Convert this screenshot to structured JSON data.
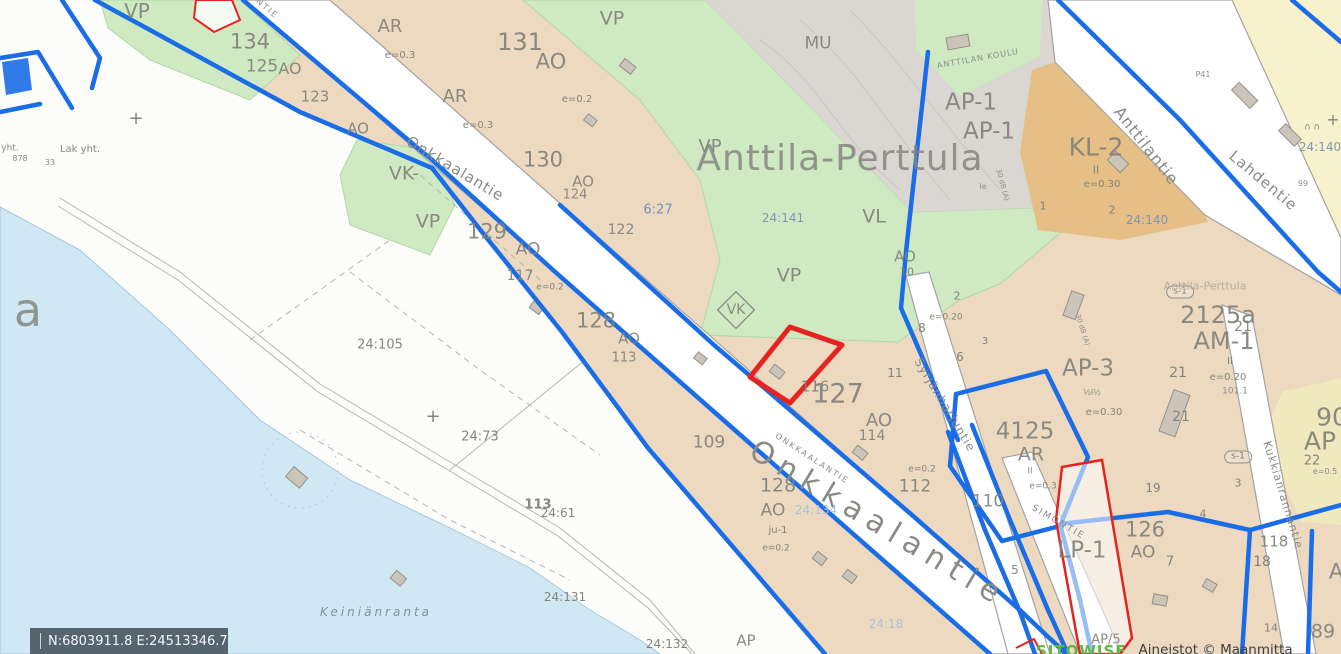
{
  "map": {
    "place_name": "Anttila-Perttula",
    "statusbar": {
      "coordinates": "N:6803911.8 E:24513346.7"
    },
    "attribution": {
      "logo_text": "SITOWISE",
      "credit_text": "Aineistot © Maanmitta"
    },
    "colors": {
      "plan_boundary_blue": "#1a6de6",
      "selected_parcel_red": "#e62320",
      "residential_tan": "#ecd9c0",
      "park_green": "#cfe9c2",
      "forest_gray": "#dad6d1",
      "commercial_orange": "#e5bf85",
      "reserve_yellow": "#f7f2cc",
      "water_blue": "#cfe8f3",
      "statusbar_bg": "#566470"
    },
    "labels": [
      {
        "t": "VP",
        "x": 137,
        "y": 11,
        "s": 20,
        "c": "zone"
      },
      {
        "t": "134",
        "x": 250,
        "y": 42,
        "s": 21,
        "c": "zone"
      },
      {
        "t": "125",
        "x": 262,
        "y": 67,
        "s": 17,
        "c": "zone"
      },
      {
        "t": "AO",
        "x": 290,
        "y": 69,
        "s": 16,
        "c": "zone"
      },
      {
        "t": "123",
        "x": 315,
        "y": 97,
        "s": 15,
        "c": "zone"
      },
      {
        "t": "AO",
        "x": 358,
        "y": 129,
        "s": 15,
        "c": "zone"
      },
      {
        "t": "AR",
        "x": 390,
        "y": 27,
        "s": 18,
        "c": "zone"
      },
      {
        "t": "e=0.3",
        "x": 400,
        "y": 56,
        "s": 10,
        "c": "num"
      },
      {
        "t": "AR",
        "x": 455,
        "y": 97,
        "s": 18,
        "c": "zone"
      },
      {
        "t": "e=0.3",
        "x": 478,
        "y": 126,
        "s": 10,
        "c": "num"
      },
      {
        "t": "131",
        "x": 520,
        "y": 42,
        "s": 24,
        "c": "zone"
      },
      {
        "t": "AO",
        "x": 551,
        "y": 62,
        "s": 21,
        "c": "zone"
      },
      {
        "t": "e=0.2",
        "x": 577,
        "y": 100,
        "s": 10,
        "c": "num"
      },
      {
        "t": "VP",
        "x": 612,
        "y": 19,
        "s": 19,
        "c": "zone"
      },
      {
        "t": "MU",
        "x": 818,
        "y": 44,
        "s": 17,
        "c": "zone"
      },
      {
        "t": "VP",
        "x": 710,
        "y": 147,
        "s": 18,
        "c": "zone"
      },
      {
        "t": "Anttila-Perttula",
        "x": 840,
        "y": 159,
        "s": 36,
        "c": "title",
        "ls": 1
      },
      {
        "t": "VK-",
        "x": 404,
        "y": 174,
        "s": 19,
        "c": "zone"
      },
      {
        "t": "VP",
        "x": 428,
        "y": 222,
        "s": 19,
        "c": "zone"
      },
      {
        "t": "129",
        "x": 487,
        "y": 232,
        "s": 21,
        "c": "zone"
      },
      {
        "t": "AO",
        "x": 528,
        "y": 250,
        "s": 17,
        "c": "zone"
      },
      {
        "t": "117",
        "x": 520,
        "y": 276,
        "s": 14,
        "c": "zone"
      },
      {
        "t": "e=0.2",
        "x": 550,
        "y": 288,
        "s": 9,
        "c": "num"
      },
      {
        "t": "130",
        "x": 543,
        "y": 160,
        "s": 21,
        "c": "zone"
      },
      {
        "t": "AO",
        "x": 583,
        "y": 182,
        "s": 15,
        "c": "zone"
      },
      {
        "t": "124",
        "x": 575,
        "y": 195,
        "s": 13,
        "c": "zone"
      },
      {
        "t": "122",
        "x": 621,
        "y": 230,
        "s": 14,
        "c": "zone"
      },
      {
        "t": "128",
        "x": 596,
        "y": 321,
        "s": 21,
        "c": "zone"
      },
      {
        "t": "AO",
        "x": 629,
        "y": 339,
        "s": 15,
        "c": "zone"
      },
      {
        "t": "113",
        "x": 624,
        "y": 358,
        "s": 13,
        "c": "zone"
      },
      {
        "t": "24:141",
        "x": 783,
        "y": 218,
        "s": 12,
        "c": "steel"
      },
      {
        "t": "VL",
        "x": 874,
        "y": 217,
        "s": 19,
        "c": "zone"
      },
      {
        "t": "VP",
        "x": 789,
        "y": 276,
        "s": 19,
        "c": "zone"
      },
      {
        "t": "VK",
        "x": 736,
        "y": 310,
        "s": 14,
        "c": "zone"
      },
      {
        "t": "AO",
        "x": 905,
        "y": 257,
        "s": 15,
        "c": "zone"
      },
      {
        "t": "10",
        "x": 907,
        "y": 272,
        "s": 11,
        "c": "num"
      },
      {
        "t": "e=0.20",
        "x": 946,
        "y": 318,
        "s": 9,
        "c": "num"
      },
      {
        "t": "2",
        "x": 957,
        "y": 296,
        "s": 11,
        "c": "num"
      },
      {
        "t": "8",
        "x": 922,
        "y": 328,
        "s": 12,
        "c": "num"
      },
      {
        "t": "3",
        "x": 985,
        "y": 342,
        "s": 10,
        "c": "num"
      },
      {
        "t": "6",
        "x": 960,
        "y": 357,
        "s": 12,
        "c": "num"
      },
      {
        "t": "11",
        "x": 895,
        "y": 373,
        "s": 12,
        "c": "num"
      },
      {
        "t": "116",
        "x": 815,
        "y": 387,
        "s": 15,
        "c": "zone"
      },
      {
        "t": "127",
        "x": 838,
        "y": 394,
        "s": 27,
        "c": "zone"
      },
      {
        "t": "AO",
        "x": 879,
        "y": 421,
        "s": 18,
        "c": "zone"
      },
      {
        "t": "114",
        "x": 872,
        "y": 436,
        "s": 14,
        "c": "zone"
      },
      {
        "t": "109",
        "x": 709,
        "y": 443,
        "s": 17,
        "c": "zone"
      },
      {
        "t": "128",
        "x": 778,
        "y": 486,
        "s": 19,
        "c": "zone"
      },
      {
        "t": "AO",
        "x": 773,
        "y": 511,
        "s": 17,
        "c": "zone"
      },
      {
        "t": "ju-1",
        "x": 778,
        "y": 531,
        "s": 10,
        "c": "num"
      },
      {
        "t": "e=0.2",
        "x": 776,
        "y": 549,
        "s": 9,
        "c": "num"
      },
      {
        "t": "112",
        "x": 915,
        "y": 487,
        "s": 17,
        "c": "zone"
      },
      {
        "t": "e=0.2",
        "x": 922,
        "y": 470,
        "s": 9,
        "c": "num"
      },
      {
        "t": "110",
        "x": 988,
        "y": 502,
        "s": 17,
        "c": "zone"
      },
      {
        "t": "24:134",
        "x": 816,
        "y": 510,
        "s": 12,
        "c": "pale"
      },
      {
        "t": "24:18",
        "x": 886,
        "y": 624,
        "s": 12,
        "c": "pale"
      },
      {
        "t": "24:132",
        "x": 667,
        "y": 644,
        "s": 12,
        "c": "num"
      },
      {
        "t": "24:131",
        "x": 565,
        "y": 597,
        "s": 12,
        "c": "num"
      },
      {
        "t": "Keiniänranta",
        "x": 376,
        "y": 612,
        "s": 12,
        "c": "water",
        "ls": 3,
        "st": "italic"
      },
      {
        "t": "24:105",
        "x": 380,
        "y": 345,
        "s": 13,
        "c": "num"
      },
      {
        "t": "24:73",
        "x": 480,
        "y": 437,
        "s": 13,
        "c": "num"
      },
      {
        "t": "113",
        "x": 538,
        "y": 505,
        "s": 13,
        "c": "num",
        "w": 600
      },
      {
        "t": "24:61",
        "x": 558,
        "y": 513,
        "s": 12,
        "c": "num"
      },
      {
        "t": "6:27",
        "x": 658,
        "y": 210,
        "s": 13,
        "c": "blue"
      },
      {
        "t": "a",
        "x": 28,
        "y": 310,
        "s": 46,
        "c": "title"
      },
      {
        "t": "Lak yht.",
        "x": 80,
        "y": 150,
        "s": 10,
        "c": "num"
      },
      {
        "t": "yht.",
        "x": 10,
        "y": 149,
        "s": 9,
        "c": "num"
      },
      {
        "t": "878",
        "x": 20,
        "y": 159,
        "s": 8,
        "c": "num"
      },
      {
        "t": "33",
        "x": 50,
        "y": 163,
        "s": 8,
        "c": "num"
      },
      {
        "t": "+",
        "x": 136,
        "y": 119,
        "s": 18,
        "c": "num"
      },
      {
        "t": "+",
        "x": 433,
        "y": 417,
        "s": 18,
        "c": "num"
      },
      {
        "t": "+",
        "x": 1333,
        "y": 120,
        "s": 16,
        "c": "num"
      },
      {
        "t": "∩ ∩",
        "x": 1312,
        "y": 128,
        "s": 9,
        "c": "num"
      },
      {
        "t": "AP-1",
        "x": 971,
        "y": 103,
        "s": 23,
        "c": "zone"
      },
      {
        "t": "AP-1",
        "x": 989,
        "y": 132,
        "s": 23,
        "c": "zone"
      },
      {
        "t": "KL-2",
        "x": 1096,
        "y": 147,
        "s": 25,
        "c": "zone"
      },
      {
        "t": "II",
        "x": 1096,
        "y": 170,
        "s": 11,
        "c": "num"
      },
      {
        "t": "e=0.30",
        "x": 1102,
        "y": 185,
        "s": 10,
        "c": "num"
      },
      {
        "t": "1",
        "x": 1043,
        "y": 206,
        "s": 11,
        "c": "num"
      },
      {
        "t": "2",
        "x": 1112,
        "y": 210,
        "s": 11,
        "c": "num"
      },
      {
        "t": "ANTTILAN KOULU",
        "x": 978,
        "y": 59,
        "s": 8,
        "c": "tiny",
        "ls": 1,
        "r": -10
      },
      {
        "t": "P41",
        "x": 1203,
        "y": 75,
        "s": 8,
        "c": "tiny"
      },
      {
        "t": "24:140",
        "x": 1147,
        "y": 220,
        "s": 12,
        "c": "steel"
      },
      {
        "t": "24:140",
        "x": 1320,
        "y": 147,
        "s": 12,
        "c": "steel"
      },
      {
        "t": "99",
        "x": 1303,
        "y": 184,
        "s": 8,
        "c": "tiny"
      },
      {
        "t": "Anttilantie",
        "x": 1146,
        "y": 146,
        "s": 16,
        "c": "street",
        "r": 52,
        "ls": 1
      },
      {
        "t": "Lahdentie",
        "x": 1263,
        "y": 181,
        "s": 15,
        "c": "street",
        "r": 40,
        "ls": 1
      },
      {
        "t": "30 dB (A)",
        "x": 1002,
        "y": 185,
        "s": 7,
        "c": "tiny",
        "r": 75
      },
      {
        "t": "le",
        "x": 983,
        "y": 187,
        "s": 8,
        "c": "tiny"
      },
      {
        "t": "30 dB (A)",
        "x": 1082,
        "y": 330,
        "s": 7,
        "c": "tiny",
        "r": 72
      },
      {
        "t": "2125a",
        "x": 1218,
        "y": 315,
        "s": 24,
        "c": "zone"
      },
      {
        "t": "21",
        "x": 1243,
        "y": 327,
        "s": 14,
        "c": "zone"
      },
      {
        "t": "AM-1",
        "x": 1224,
        "y": 341,
        "s": 24,
        "c": "zone"
      },
      {
        "t": "s-1",
        "x": 1180,
        "y": 292,
        "s": 9,
        "c": "oval"
      },
      {
        "t": "s-1",
        "x": 1238,
        "y": 457,
        "s": 9,
        "c": "oval"
      },
      {
        "t": "Anttila-Perttula",
        "x": 1205,
        "y": 286,
        "s": 11,
        "c": "faint"
      },
      {
        "t": "AP-3",
        "x": 1088,
        "y": 369,
        "s": 23,
        "c": "zone"
      },
      {
        "t": "½I½",
        "x": 1092,
        "y": 393,
        "s": 8,
        "c": "tiny"
      },
      {
        "t": "e=0.30",
        "x": 1104,
        "y": 413,
        "s": 10,
        "c": "num"
      },
      {
        "t": "21",
        "x": 1178,
        "y": 373,
        "s": 14,
        "c": "num"
      },
      {
        "t": "II",
        "x": 1230,
        "y": 362,
        "s": 10,
        "c": "num"
      },
      {
        "t": "e=0.20",
        "x": 1228,
        "y": 378,
        "s": 10,
        "c": "num"
      },
      {
        "t": "101.1",
        "x": 1235,
        "y": 392,
        "s": 9,
        "c": "tiny"
      },
      {
        "t": "21",
        "x": 1181,
        "y": 417,
        "s": 14,
        "c": "num"
      },
      {
        "t": "4125",
        "x": 1025,
        "y": 432,
        "s": 23,
        "c": "zone"
      },
      {
        "t": "AR",
        "x": 1031,
        "y": 455,
        "s": 19,
        "c": "zone"
      },
      {
        "t": "II",
        "x": 1030,
        "y": 472,
        "s": 9,
        "c": "tiny"
      },
      {
        "t": "e=0.3",
        "x": 1043,
        "y": 487,
        "s": 9,
        "c": "num"
      },
      {
        "t": "Syrjänharjuntie",
        "x": 945,
        "y": 405,
        "s": 12,
        "c": "street",
        "r": 59,
        "ls": 1
      },
      {
        "t": "SIMONTIE",
        "x": 1058,
        "y": 523,
        "s": 9,
        "c": "street",
        "r": 30,
        "ls": 2
      },
      {
        "t": "LP-1",
        "x": 1082,
        "y": 551,
        "s": 23,
        "c": "zone"
      },
      {
        "t": "126",
        "x": 1145,
        "y": 530,
        "s": 21,
        "c": "zone"
      },
      {
        "t": "AO",
        "x": 1143,
        "y": 553,
        "s": 17,
        "c": "zone"
      },
      {
        "t": "7",
        "x": 1170,
        "y": 562,
        "s": 13,
        "c": "num"
      },
      {
        "t": "19",
        "x": 1153,
        "y": 488,
        "s": 12,
        "c": "num"
      },
      {
        "t": "4",
        "x": 1203,
        "y": 514,
        "s": 11,
        "c": "num"
      },
      {
        "t": "3",
        "x": 1238,
        "y": 483,
        "s": 11,
        "c": "num"
      },
      {
        "t": "5",
        "x": 1015,
        "y": 570,
        "s": 12,
        "c": "num"
      },
      {
        "t": "118",
        "x": 1274,
        "y": 542,
        "s": 15,
        "c": "zone"
      },
      {
        "t": "18",
        "x": 1262,
        "y": 562,
        "s": 14,
        "c": "num"
      },
      {
        "t": "90",
        "x": 1332,
        "y": 417,
        "s": 25,
        "c": "zone"
      },
      {
        "t": "AP",
        "x": 1320,
        "y": 441,
        "s": 25,
        "c": "zone"
      },
      {
        "t": "22",
        "x": 1312,
        "y": 461,
        "s": 13,
        "c": "num"
      },
      {
        "t": "e=0.5",
        "x": 1325,
        "y": 472,
        "s": 8,
        "c": "tiny"
      },
      {
        "t": "Kukkianrannantie",
        "x": 1283,
        "y": 495,
        "s": 11,
        "c": "street",
        "r": 73,
        "ls": 1
      },
      {
        "t": "A",
        "x": 1336,
        "y": 572,
        "s": 21,
        "c": "zone"
      },
      {
        "t": "89",
        "x": 1323,
        "y": 632,
        "s": 19,
        "c": "zone"
      },
      {
        "t": "14",
        "x": 1271,
        "y": 628,
        "s": 11,
        "c": "num"
      },
      {
        "t": "AP",
        "x": 746,
        "y": 641,
        "s": 15,
        "c": "zone"
      },
      {
        "t": "AP/5",
        "x": 1106,
        "y": 640,
        "s": 13,
        "c": "zone"
      },
      {
        "t": "Onkkaalantie",
        "x": 878,
        "y": 524,
        "s": 30,
        "c": "street",
        "r": 31,
        "ls": 8
      },
      {
        "t": "ONKKAALANTIE",
        "x": 812,
        "y": 459,
        "s": 8,
        "c": "street",
        "r": 33,
        "ls": 2
      },
      {
        "t": "Onkkaalantie",
        "x": 455,
        "y": 169,
        "s": 15,
        "c": "street",
        "r": 31,
        "ls": 1
      },
      {
        "t": "NTIE",
        "x": 267,
        "y": 9,
        "s": 8,
        "c": "street",
        "r": 40,
        "ls": 2
      }
    ]
  }
}
